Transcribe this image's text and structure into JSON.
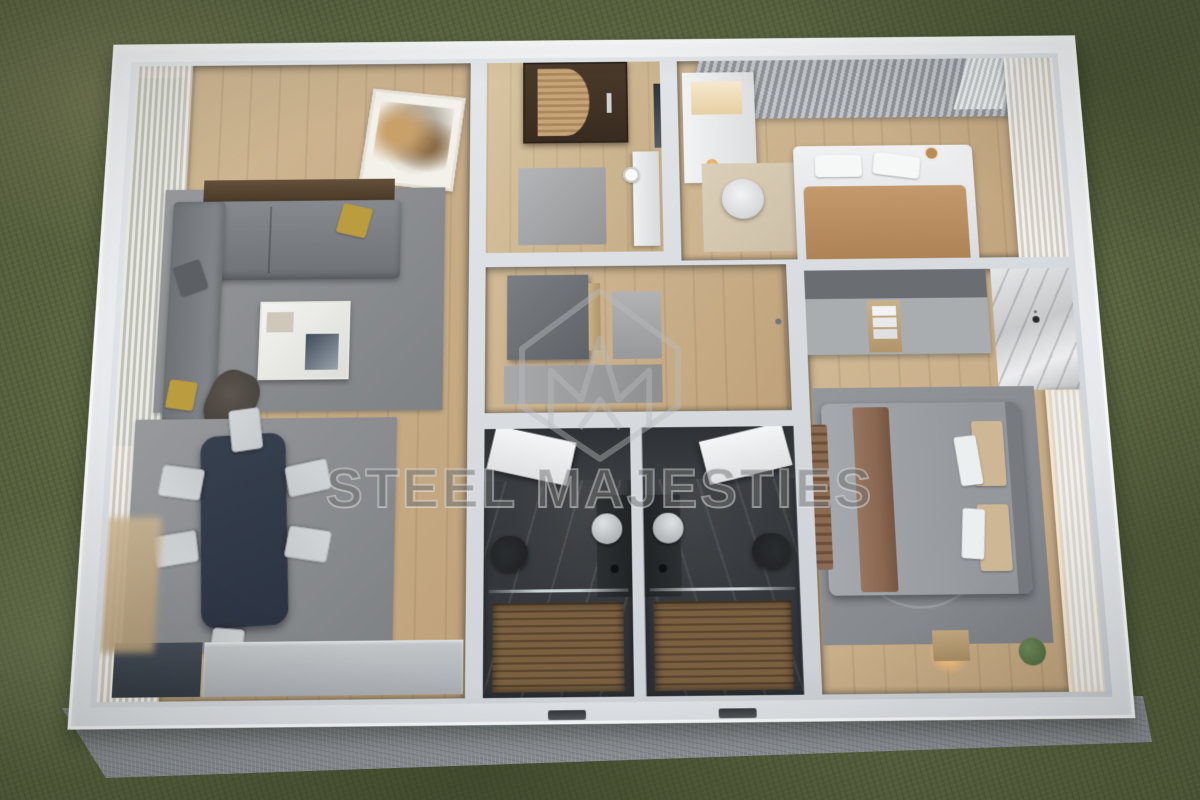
{
  "watermark": {
    "text": "STEEL MAJESTIES",
    "logo": "m-crown-diamond-logo"
  },
  "scene": {
    "type": "3d-floor-plan-render",
    "setting": "grass-field",
    "rooms": [
      "living-dining-room",
      "entry-hall",
      "inner-hallway",
      "bathroom-left",
      "bathroom-right",
      "kids-bedroom",
      "master-bedroom"
    ]
  },
  "palette": {
    "grass": "#5c6743",
    "grass_dark": "#454f2e",
    "grass_light": "#7d8660",
    "concrete": "#a6abb1",
    "wall": "#e8ebee",
    "wall_shadow": "#c9ced4",
    "wood": "#d2bb97",
    "wood_dark": "#bfa27b",
    "wood_entry": "#d8c5a2",
    "rug": "#97999c",
    "rug_dark": "#7f8285",
    "sofa": "#868a8e",
    "sofa_dark": "#6e7276",
    "pillow_yellow": "#bb9c3f",
    "table_navy": "#2c3443",
    "chair_light": "#c7cacd",
    "bath_floor": "#3b3e42",
    "bath_wall": "#2e3135",
    "shower_wood": "#7a5f41",
    "fixture_black": "#1e2023",
    "duvet": "#a5a8ad",
    "throw_brown": "#8a6751",
    "blanket_camel": "#c49a6c",
    "pillow_beige": "#cdb795",
    "curtain_gray": "#b5b9be",
    "curtain_sheer": "#efedea",
    "marble": "#d9dadc",
    "door_tan": "#c6a478",
    "art_beige": "#c9a06a",
    "glow": "#f2bd7c",
    "plant_green": "#5c7a49",
    "window_green": "#6f8a55",
    "watermark_gray": "#4b4b4b"
  }
}
